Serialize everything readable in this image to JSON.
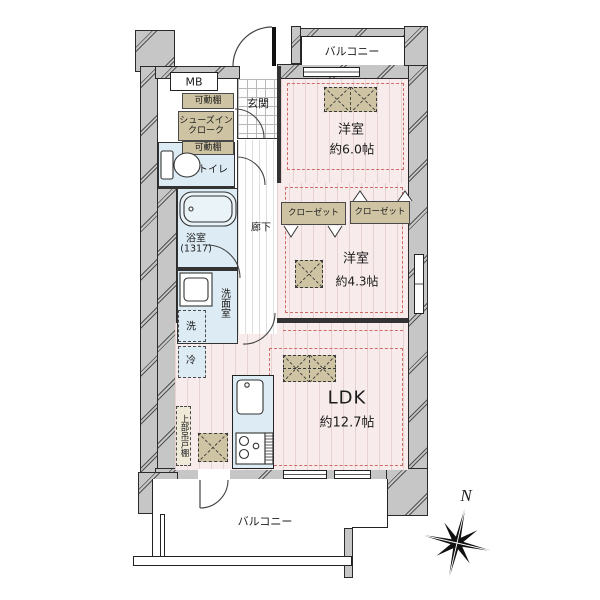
{
  "labels": {
    "balcony_top": "バルコニー",
    "balcony_bottom": "バルコニー",
    "mb": "MB",
    "shelf_top": "可動棚",
    "sic_line1": "シューズイン",
    "sic_line2": "クローク",
    "shelf_bottom": "可動棚",
    "entrance": "玄関",
    "corridor": "廊下",
    "toilet": "トイレ",
    "bath_name": "浴室",
    "bath_size": "(1317)",
    "washroom": "洗面室",
    "washer": "洗",
    "fridge": "冷",
    "bedroom1_name": "洋室",
    "bedroom1_size": "約6.0帖",
    "bedroom2_name": "洋室",
    "bedroom2_size": "約4.3帖",
    "closet_left": "クローゼット",
    "closet_right": "クローゼット",
    "ldk_name": "LDK",
    "ldk_size": "約12.7帖",
    "upper_cabinet": "上部吊戸棚",
    "compass_north": "N"
  },
  "colors": {
    "wall_gray": "#c6c6c6",
    "room_pink": "#f7ebeb",
    "wet_blue": "#dcebf4",
    "wood_beige": "#cec3a2",
    "zone_dashed_red": "#cf6a66"
  }
}
